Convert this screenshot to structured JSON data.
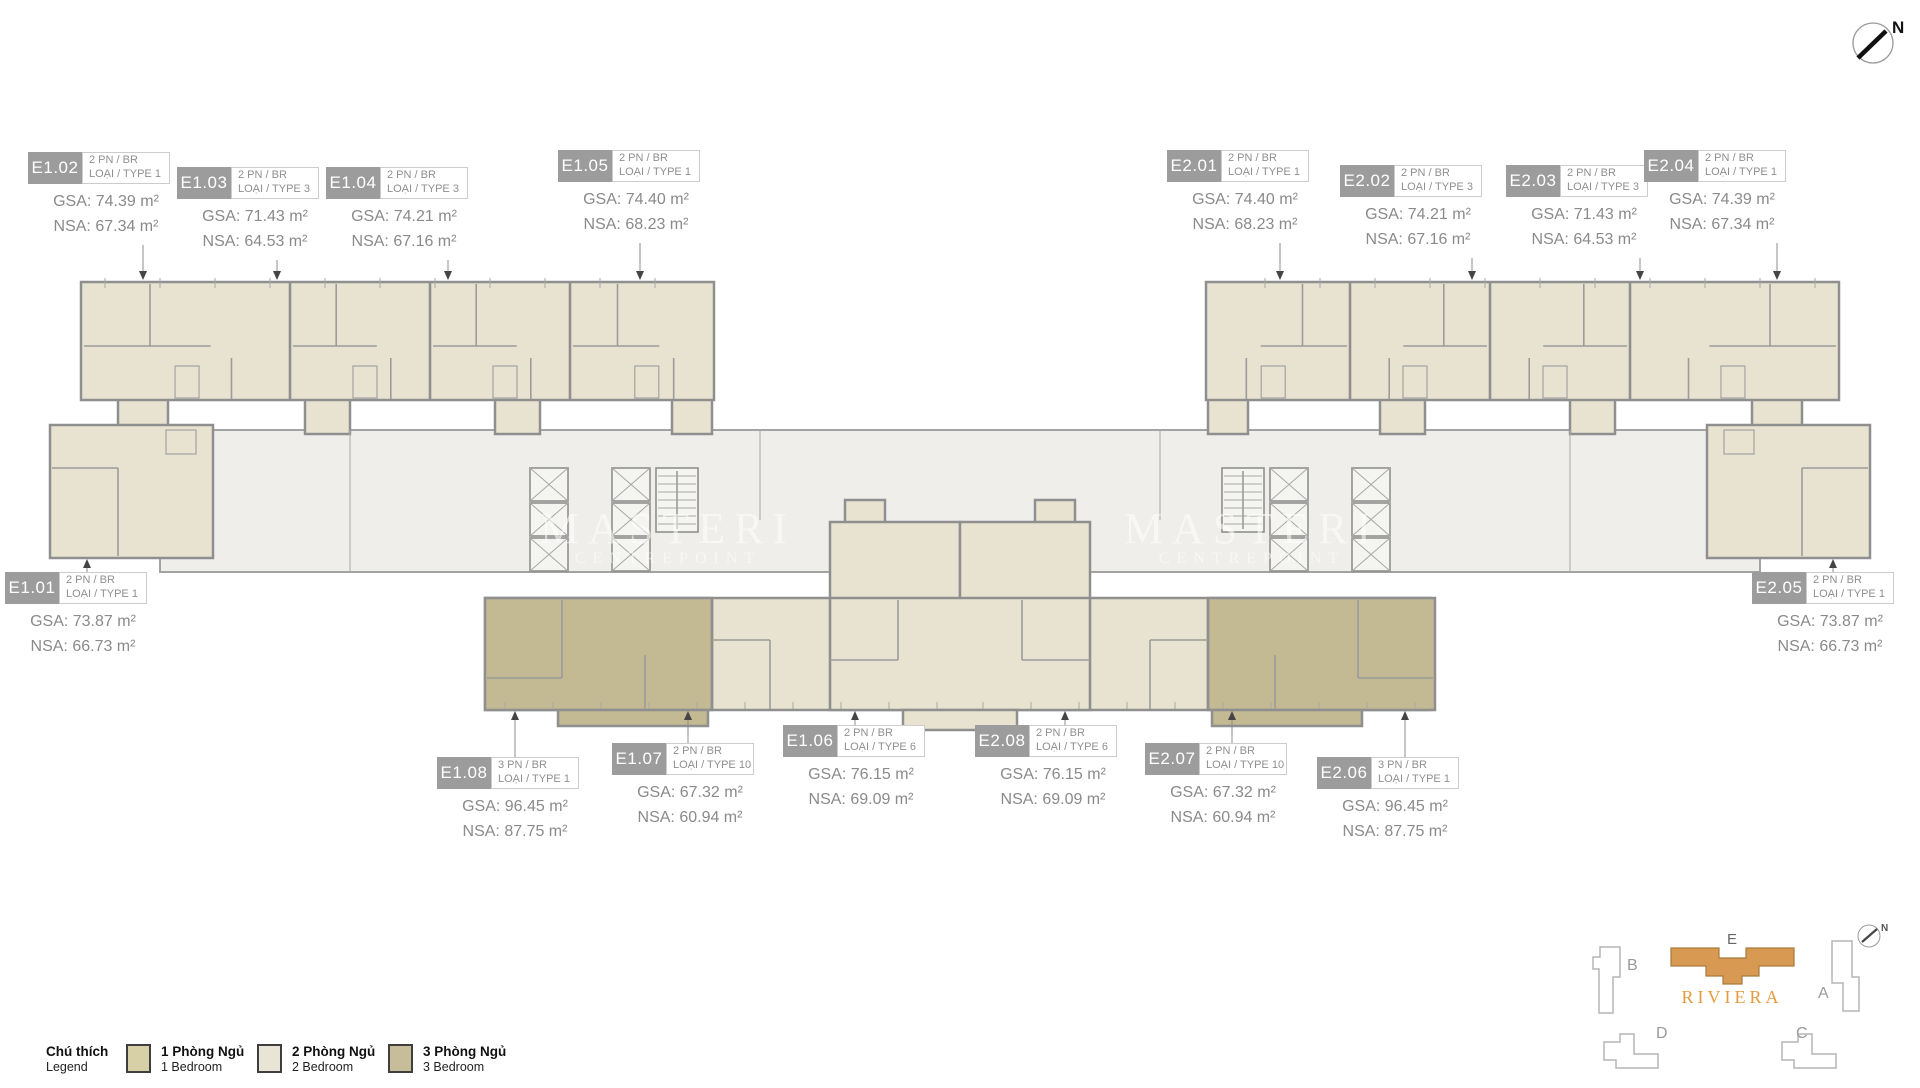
{
  "compass": {
    "north_label": "N"
  },
  "watermark": {
    "line1": "MASTERI",
    "line2": "CENTREPOINT"
  },
  "units": [
    {
      "id": "E1.02",
      "bedrooms_line": "2 PN / BR",
      "type_line": "LOẠI / TYPE 1",
      "gsa": "GSA: 74.39 m²",
      "nsa": "NSA: 67.34 m²"
    },
    {
      "id": "E1.03",
      "bedrooms_line": "2 PN / BR",
      "type_line": "LOẠI / TYPE 3",
      "gsa": "GSA: 71.43 m²",
      "nsa": "NSA: 64.53 m²"
    },
    {
      "id": "E1.04",
      "bedrooms_line": "2 PN / BR",
      "type_line": "LOẠI / TYPE 3",
      "gsa": "GSA: 74.21 m²",
      "nsa": "NSA: 67.16 m²"
    },
    {
      "id": "E1.05",
      "bedrooms_line": "2 PN / BR",
      "type_line": "LOẠI / TYPE 1",
      "gsa": "GSA: 74.40 m²",
      "nsa": "NSA: 68.23 m²"
    },
    {
      "id": "E2.01",
      "bedrooms_line": "2 PN / BR",
      "type_line": "LOẠI / TYPE 1",
      "gsa": "GSA: 74.40 m²",
      "nsa": "NSA: 68.23 m²"
    },
    {
      "id": "E2.02",
      "bedrooms_line": "2 PN / BR",
      "type_line": "LOẠI / TYPE 3",
      "gsa": "GSA: 74.21 m²",
      "nsa": "NSA: 67.16 m²"
    },
    {
      "id": "E2.03",
      "bedrooms_line": "2 PN / BR",
      "type_line": "LOẠI / TYPE 3",
      "gsa": "GSA: 71.43 m²",
      "nsa": "NSA: 64.53 m²"
    },
    {
      "id": "E2.04",
      "bedrooms_line": "2 PN / BR",
      "type_line": "LOẠI / TYPE 1",
      "gsa": "GSA: 74.39 m²",
      "nsa": "NSA: 67.34 m²"
    },
    {
      "id": "E1.01",
      "bedrooms_line": "2 PN / BR",
      "type_line": "LOẠI / TYPE 1",
      "gsa": "GSA: 73.87 m²",
      "nsa": "NSA: 66.73 m²"
    },
    {
      "id": "E2.05",
      "bedrooms_line": "2 PN / BR",
      "type_line": "LOẠI / TYPE 1",
      "gsa": "GSA: 73.87 m²",
      "nsa": "NSA: 66.73 m²"
    },
    {
      "id": "E1.08",
      "bedrooms_line": "3 PN / BR",
      "type_line": "LOẠI / TYPE 1",
      "gsa": "GSA: 96.45 m²",
      "nsa": "NSA: 87.75 m²"
    },
    {
      "id": "E1.07",
      "bedrooms_line": "2 PN / BR",
      "type_line": "LOẠI / TYPE 10",
      "gsa": "GSA: 67.32 m²",
      "nsa": "NSA: 60.94 m²"
    },
    {
      "id": "E1.06",
      "bedrooms_line": "2 PN / BR",
      "type_line": "LOẠI / TYPE 6",
      "gsa": "GSA: 76.15 m²",
      "nsa": "NSA: 69.09 m²"
    },
    {
      "id": "E2.08",
      "bedrooms_line": "2 PN / BR",
      "type_line": "LOẠI / TYPE 6",
      "gsa": "GSA: 76.15 m²",
      "nsa": "NSA: 69.09 m²"
    },
    {
      "id": "E2.07",
      "bedrooms_line": "2 PN / BR",
      "type_line": "LOẠI / TYPE 10",
      "gsa": "GSA: 67.32 m²",
      "nsa": "NSA: 60.94 m²"
    },
    {
      "id": "E2.06",
      "bedrooms_line": "3 PN / BR",
      "type_line": "LOẠI / TYPE 1",
      "gsa": "GSA: 96.45 m²",
      "nsa": "NSA: 87.75 m²"
    }
  ],
  "legend": {
    "title_vi": "Chú thích",
    "title_en": "Legend",
    "items": [
      {
        "label_vi": "1 Phòng Ngủ",
        "label_en": "1 Bedroom",
        "color": "#d7cfa6"
      },
      {
        "label_vi": "2 Phòng Ngủ",
        "label_en": "2 Bedroom",
        "color": "#e9e5d6"
      },
      {
        "label_vi": "3 Phòng Ngủ",
        "label_en": "3 Bedroom",
        "color": "#c7bd99"
      }
    ]
  },
  "site_key": {
    "project_name": "RIVIERA",
    "highlighted_building": "E",
    "buildings": {
      "a": "A",
      "b": "B",
      "c": "C",
      "d": "D",
      "e": "E"
    },
    "highlight_color": "#d89a52"
  },
  "colors": {
    "unit_2br_fill": "#e8e3d0",
    "unit_3br_fill": "#c3b992",
    "corridor_fill": "#efeeeb",
    "wall": "#9b9b9b",
    "label_badge": "#9c9c9c",
    "accent_orange": "#e39c3f"
  }
}
